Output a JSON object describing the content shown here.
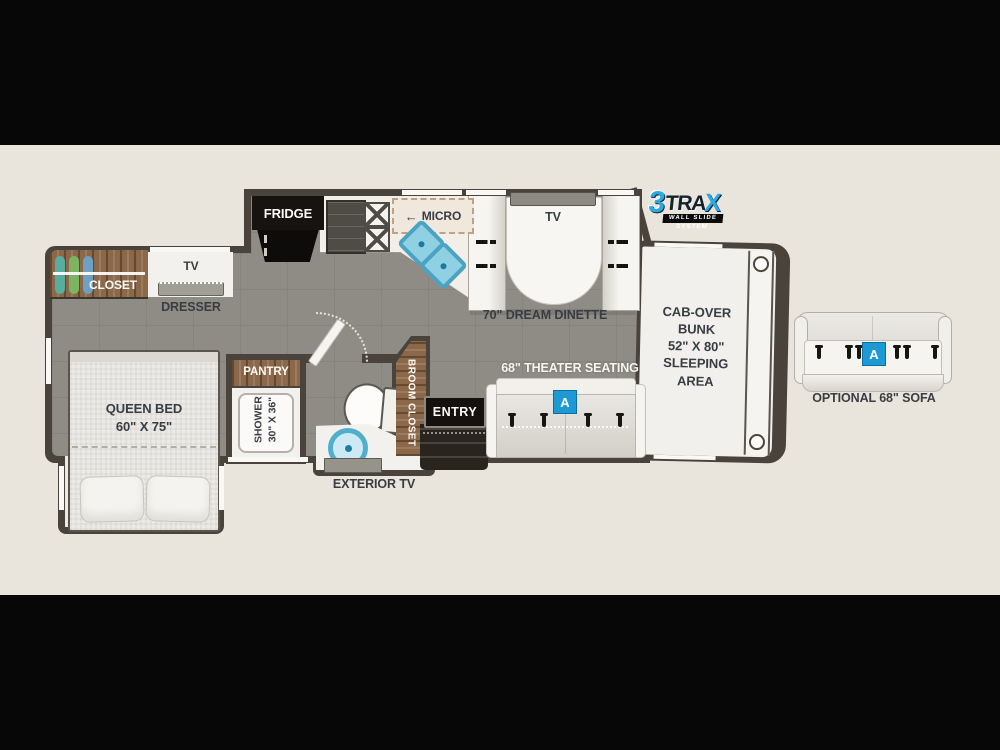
{
  "logo": {
    "num": "3",
    "mid": "TRA",
    "x": "X",
    "tagline": "WALL SLIDE SYSTEM"
  },
  "labels": {
    "closet": "CLOSET",
    "bedroom_tv": "TV",
    "dresser": "DRESSER",
    "queen_bed": "QUEEN BED\n60\" X 75\"",
    "pantry": "PANTRY",
    "shower": "SHOWER\n30\" X 36\"",
    "broom_closet": "BROOM CLOSET",
    "exterior_tv": "EXTERIOR TV",
    "entry": "ENTRY",
    "fridge": "FRIDGE",
    "micro_arrow": "←",
    "micro": "MICRO",
    "dinette_tv": "TV",
    "dream_dinette": "70\" DREAM DINETTE",
    "theater_seating": "68\" THEATER SEATING",
    "cab_over_bunk": "CAB-OVER\nBUNK\n52\" X 80\"\nSLEEPING\nAREA",
    "optional_sofa": "OPTIONAL 68\" SOFA",
    "option_badge": "A"
  },
  "colors": {
    "background": "#070707",
    "canvas": "#e9e5dc",
    "wall": "#4a433c",
    "floor": "#8f8c85",
    "wood": "#8b684a",
    "white_furniture": "#f3f1ed",
    "sink_blue": "#8fd0e2",
    "badge_blue": "#1d9ad4",
    "logo_blue": "#2ba9e0",
    "label_dark": "#383d44"
  }
}
